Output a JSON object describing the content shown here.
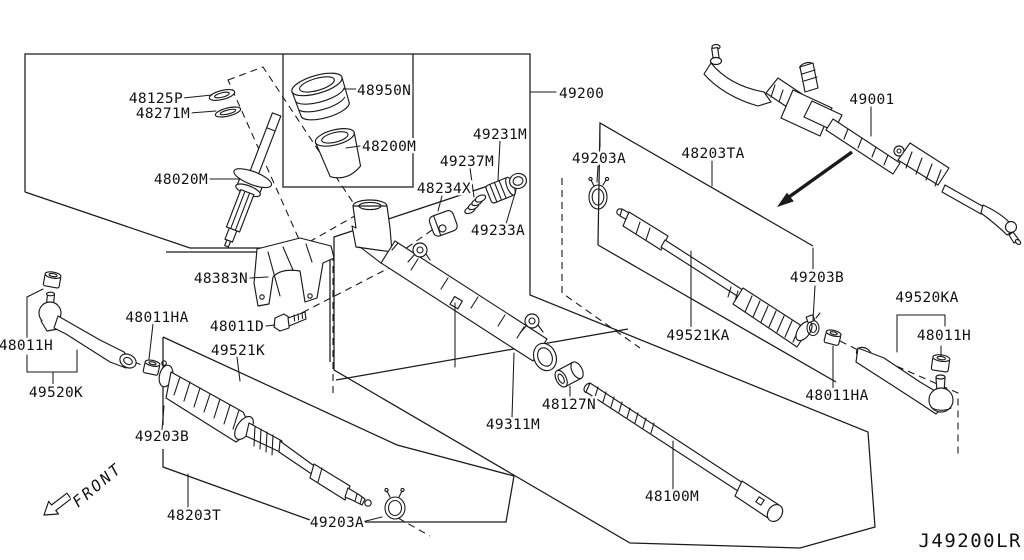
{
  "diagram": {
    "type": "parts-exploded-diagram",
    "subject": "power steering gear and linkage",
    "id_code": "J49200LR",
    "front_label": "FRONT",
    "colors": {
      "background": "#ffffff",
      "line": "#1a1a1a",
      "text": "#111111"
    },
    "labels": [
      {
        "id": "48125P",
        "text": "48125P",
        "x": 183,
        "y": 103,
        "anchor": "end"
      },
      {
        "id": "48271M",
        "text": "48271M",
        "x": 190,
        "y": 118,
        "anchor": "end"
      },
      {
        "id": "48020M",
        "text": "48020M",
        "x": 208,
        "y": 184,
        "anchor": "end"
      },
      {
        "id": "48950N",
        "text": "48950N",
        "x": 357,
        "y": 95,
        "anchor": "start"
      },
      {
        "id": "48200M",
        "text": "48200M",
        "x": 362,
        "y": 151,
        "anchor": "start"
      },
      {
        "id": "49231M",
        "text": "49231M",
        "x": 500,
        "y": 139,
        "anchor": "middle"
      },
      {
        "id": "49237M",
        "text": "49237M",
        "x": 467,
        "y": 166,
        "anchor": "middle"
      },
      {
        "id": "48234X",
        "text": "48234X",
        "x": 444,
        "y": 193,
        "anchor": "middle"
      },
      {
        "id": "49233A",
        "text": "49233A",
        "x": 498,
        "y": 235,
        "anchor": "middle"
      },
      {
        "id": "49200",
        "text": "49200",
        "x": 559,
        "y": 98,
        "anchor": "start"
      },
      {
        "id": "49001",
        "text": "49001",
        "x": 872,
        "y": 104,
        "anchor": "middle"
      },
      {
        "id": "49203A-right",
        "text": "49203A",
        "x": 599,
        "y": 163,
        "anchor": "middle"
      },
      {
        "id": "48203TA",
        "text": "48203TA",
        "x": 713,
        "y": 158,
        "anchor": "middle"
      },
      {
        "id": "49203B-right",
        "text": "49203B",
        "x": 817,
        "y": 282,
        "anchor": "middle"
      },
      {
        "id": "49520KA",
        "text": "49520KA",
        "x": 927,
        "y": 302,
        "anchor": "middle"
      },
      {
        "id": "48011H-right",
        "text": "48011H",
        "x": 944,
        "y": 340,
        "anchor": "middle"
      },
      {
        "id": "48011HA-right",
        "text": "48011HA",
        "x": 837,
        "y": 400,
        "anchor": "middle"
      },
      {
        "id": "49521KA",
        "text": "49521KA",
        "x": 698,
        "y": 340,
        "anchor": "middle"
      },
      {
        "id": "48127N",
        "text": "48127N",
        "x": 569,
        "y": 409,
        "anchor": "middle"
      },
      {
        "id": "49311M",
        "text": "49311M",
        "x": 513,
        "y": 429,
        "anchor": "middle"
      },
      {
        "id": "48100M",
        "text": "48100M",
        "x": 672,
        "y": 501,
        "anchor": "middle"
      },
      {
        "id": "48383N",
        "text": "48383N",
        "x": 248,
        "y": 283,
        "anchor": "end"
      },
      {
        "id": "48011D",
        "text": "48011D",
        "x": 264,
        "y": 331,
        "anchor": "end"
      },
      {
        "id": "48011HA-left",
        "text": "48011HA",
        "x": 157,
        "y": 322,
        "anchor": "middle"
      },
      {
        "id": "49521K",
        "text": "49521K",
        "x": 238,
        "y": 355,
        "anchor": "middle"
      },
      {
        "id": "48011H-left",
        "text": "48011H",
        "x": 53,
        "y": 350,
        "anchor": "end"
      },
      {
        "id": "49520K",
        "text": "49520K",
        "x": 56,
        "y": 397,
        "anchor": "middle"
      },
      {
        "id": "49203B-left",
        "text": "49203B",
        "x": 162,
        "y": 441,
        "anchor": "middle"
      },
      {
        "id": "48203T",
        "text": "48203T",
        "x": 194,
        "y": 520,
        "anchor": "middle"
      },
      {
        "id": "49203A-bottom",
        "text": "49203A",
        "x": 337,
        "y": 527,
        "anchor": "middle"
      }
    ]
  }
}
